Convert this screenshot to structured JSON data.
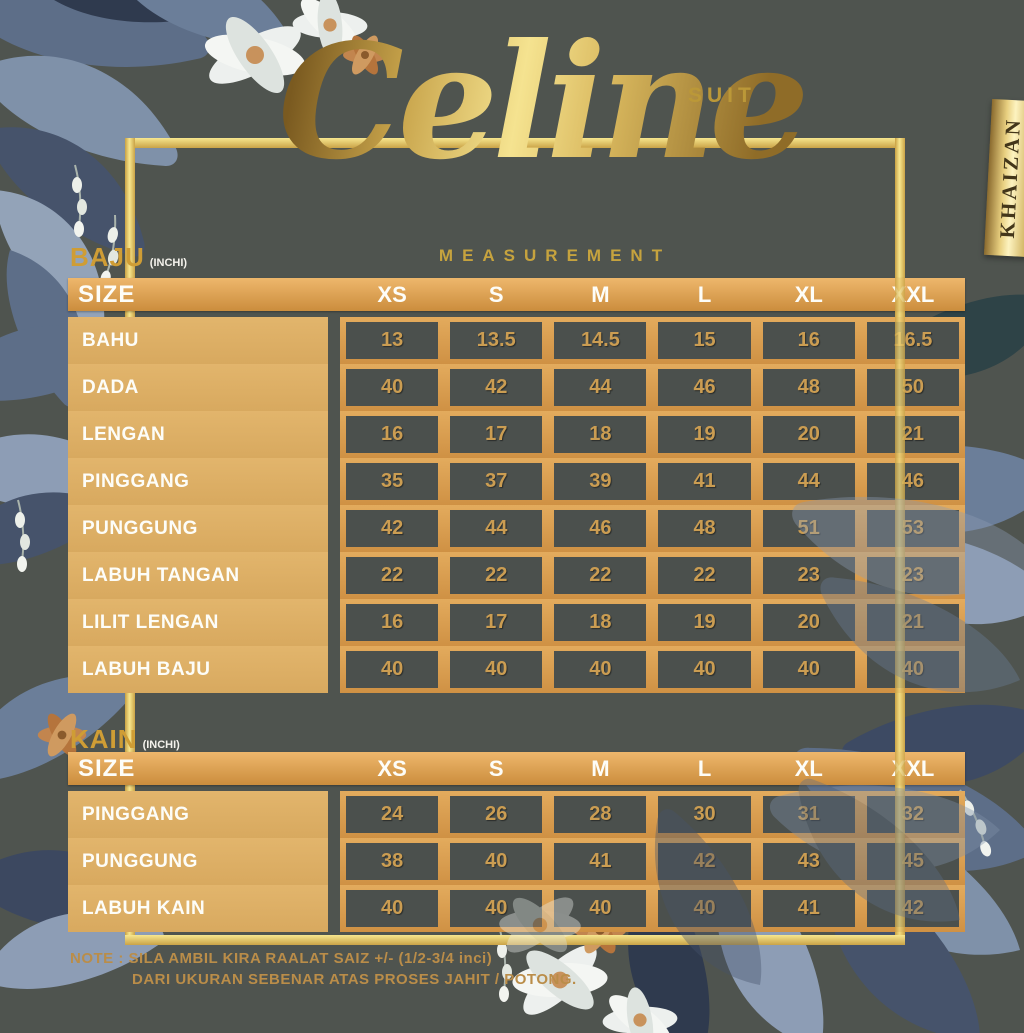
{
  "header": {
    "title": "Celine",
    "subtitle": "SUIT",
    "brand": "KHAIZAN",
    "measurement_label": "MEASUREMENT"
  },
  "size_header_label": "SIZE",
  "sizes": [
    "XS",
    "S",
    "M",
    "L",
    "XL",
    "XXL"
  ],
  "baju": {
    "section_label": "BAJU",
    "unit": "(INCHI)",
    "rows": [
      {
        "label": "BAHU",
        "values": [
          "13",
          "13.5",
          "14.5",
          "15",
          "16",
          "16.5"
        ]
      },
      {
        "label": "DADA",
        "values": [
          "40",
          "42",
          "44",
          "46",
          "48",
          "50"
        ]
      },
      {
        "label": "LENGAN",
        "values": [
          "16",
          "17",
          "18",
          "19",
          "20",
          "21"
        ]
      },
      {
        "label": "PINGGANG",
        "values": [
          "35",
          "37",
          "39",
          "41",
          "44",
          "46"
        ]
      },
      {
        "label": "PUNGGUNG",
        "values": [
          "42",
          "44",
          "46",
          "48",
          "51",
          "53"
        ]
      },
      {
        "label": "LABUH TANGAN",
        "values": [
          "22",
          "22",
          "22",
          "22",
          "23",
          "23"
        ]
      },
      {
        "label": "LILIT LENGAN",
        "values": [
          "16",
          "17",
          "18",
          "19",
          "20",
          "21"
        ]
      },
      {
        "label": "LABUH BAJU",
        "values": [
          "40",
          "40",
          "40",
          "40",
          "40",
          "40"
        ]
      }
    ]
  },
  "kain": {
    "section_label": "KAIN",
    "unit": "(INCHI)",
    "rows": [
      {
        "label": "PINGGANG",
        "values": [
          "24",
          "26",
          "28",
          "30",
          "31",
          "32"
        ]
      },
      {
        "label": "PUNGGUNG",
        "values": [
          "38",
          "40",
          "41",
          "42",
          "43",
          "45"
        ]
      },
      {
        "label": "LABUH KAIN",
        "values": [
          "40",
          "40",
          "40",
          "40",
          "41",
          "42"
        ]
      }
    ]
  },
  "note": {
    "line1": "NOTE : SILA AMBIL KIRA RAALAT SAIZ +/- (1/2-3/4 inci)",
    "line2": "DARI UKURAN SEBENAR ATAS PROSES JAHIT / POTONG."
  },
  "colors": {
    "background": "#4f544f",
    "frame_gold": "#f2dd82",
    "table_gold": "#d9a55c",
    "label_band": "#ddb067",
    "cell_dark": "#4b504d",
    "value_text": "#cb9d52",
    "accent_gold": "#c6a33e",
    "leaf_slate": "#5d6e88",
    "leaf_navy": "#3c4860"
  }
}
